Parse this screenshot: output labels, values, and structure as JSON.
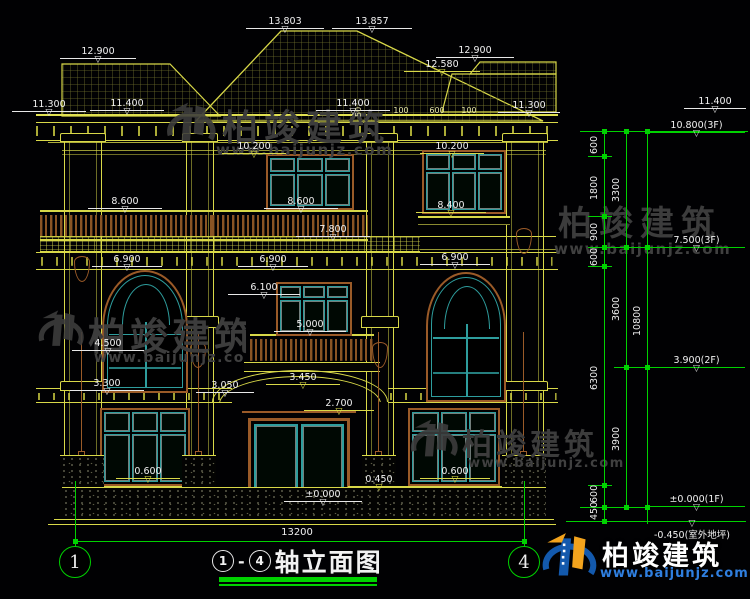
{
  "watermark": {
    "brand": "柏竣建筑",
    "url": "www.baijunjz.com"
  },
  "title": {
    "axis_start": "1",
    "separator": "-",
    "axis_end": "4",
    "text": "轴立面图"
  },
  "axis_bubbles": {
    "left": "1",
    "right": "4"
  },
  "overall_dim": "13200",
  "small_dims": [
    "100",
    "600",
    "100",
    "50"
  ],
  "chain1": [
    "600",
    "1800",
    "900",
    "600",
    "6300",
    "600",
    "450"
  ],
  "chain2": [
    "3300",
    "3600",
    "3900"
  ],
  "chain3": [
    "10800"
  ],
  "floor_marks": [
    "10.800(3F)",
    "7.500(3F)",
    "3.900(2F)",
    "±0.000(1F)",
    "-0.450(室外地坪)"
  ],
  "elevations": [
    "13.803",
    "13.857",
    "12.900",
    "12.900",
    "12.580",
    "11.300",
    "11.400",
    "11.400",
    "11.300",
    "11.400",
    "10.200",
    "10.200",
    "8.600",
    "8.600",
    "8.400",
    "7.800",
    "6.900",
    "6.900",
    "6.900",
    "6.100",
    "5.000",
    "4.500",
    "3.450",
    "3.300",
    "3.050",
    "2.700",
    "0.600",
    "0.600",
    "0.450",
    "±0.000"
  ]
}
